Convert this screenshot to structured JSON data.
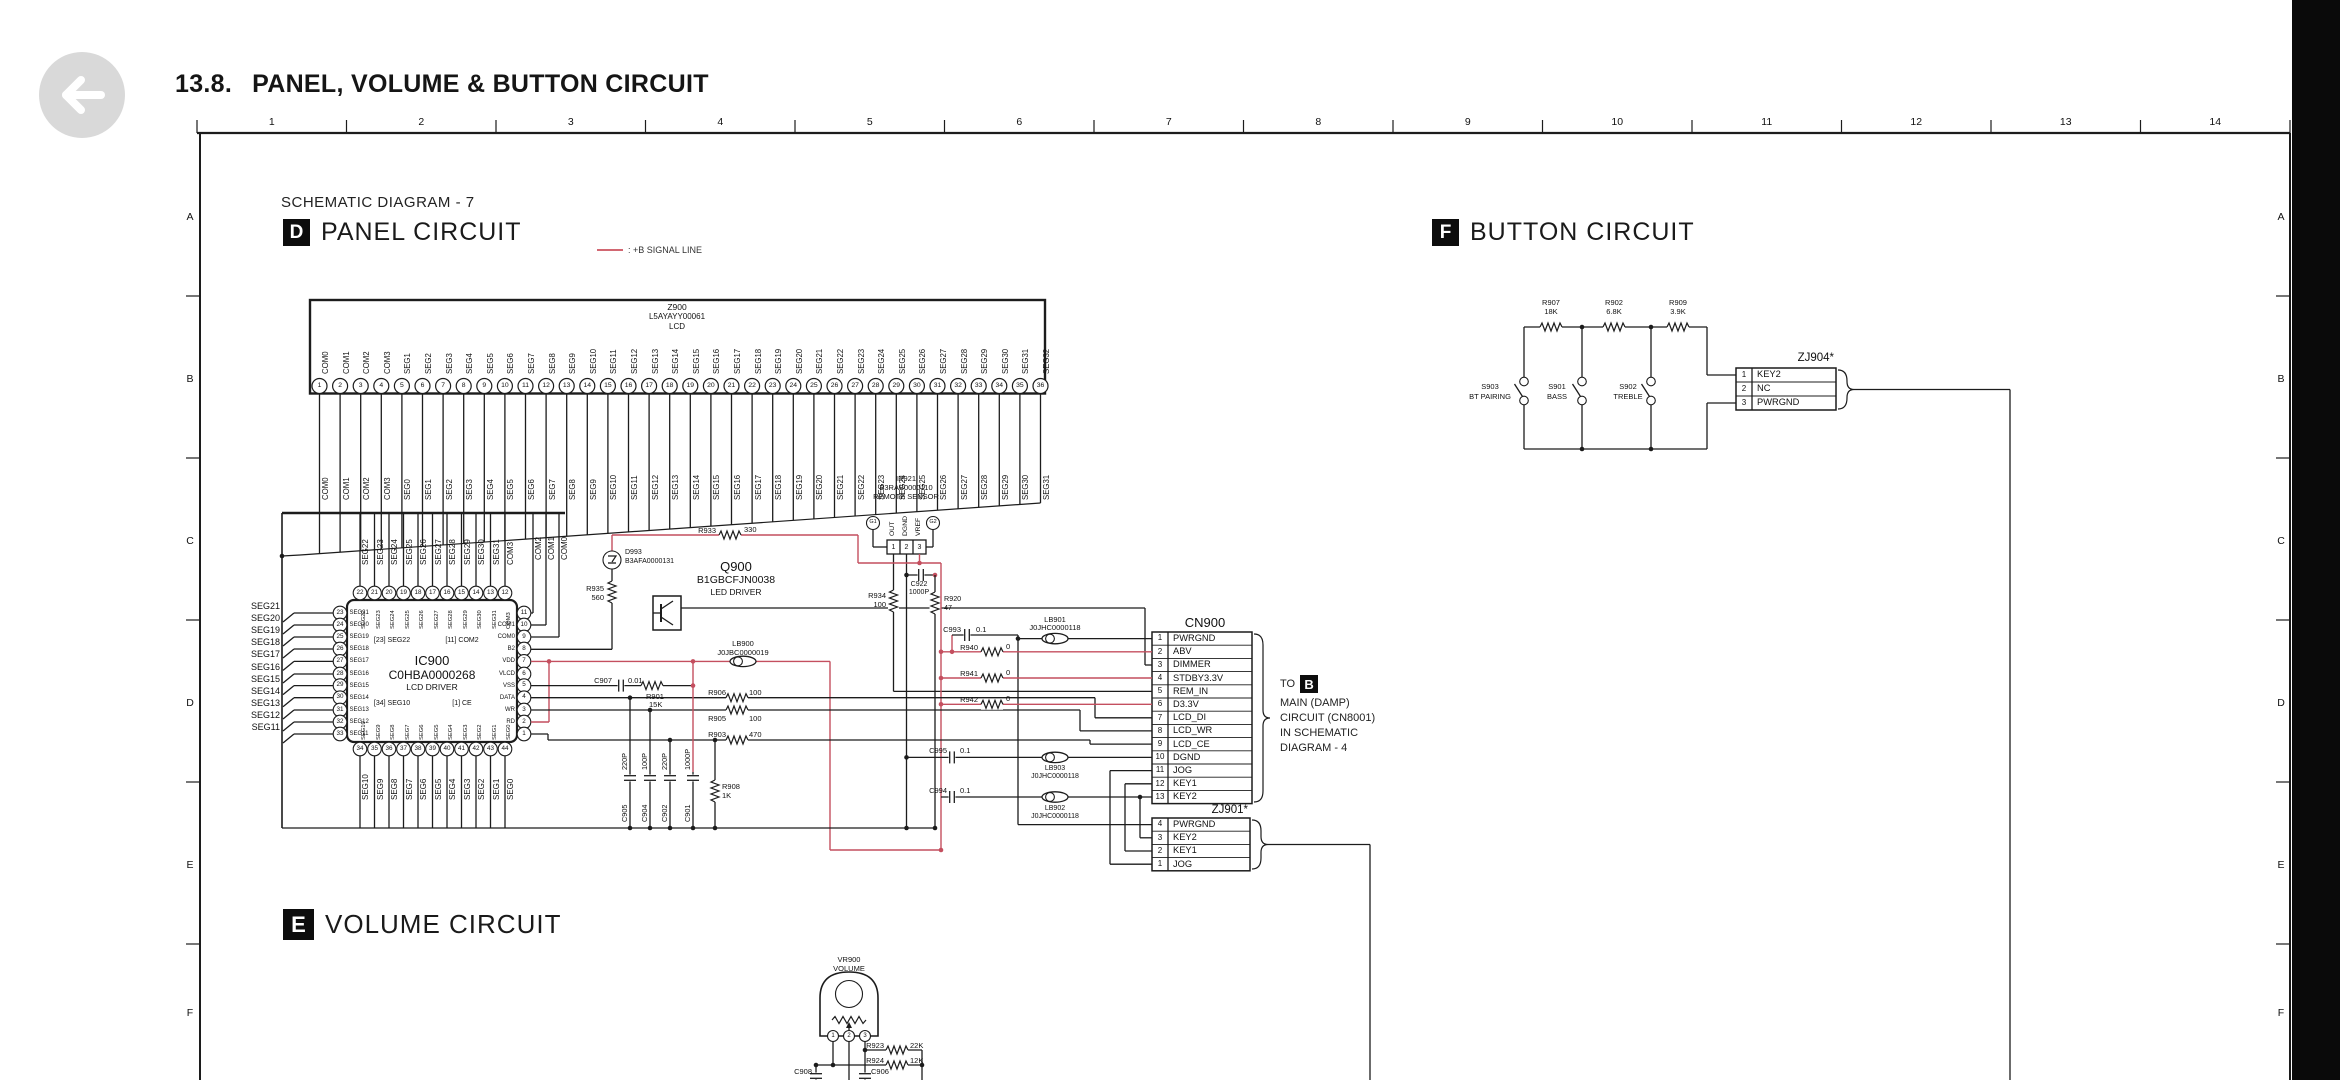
{
  "page": {
    "title_no": "13.8.",
    "title": "PANEL, VOLUME & BUTTON CIRCUIT",
    "schematic_label": "SCHEMATIC DIAGRAM - 7",
    "red": "#c44f5f",
    "black_bar": "#0a0a0a",
    "back_button_icon": "left-arrow"
  },
  "ruler": {
    "columns": [
      "1",
      "2",
      "3",
      "4",
      "5",
      "6",
      "7",
      "8",
      "9",
      "10",
      "11",
      "12",
      "13",
      "14"
    ],
    "rows": [
      "A",
      "B",
      "C",
      "D",
      "E",
      "F"
    ]
  },
  "sections": {
    "panel": {
      "badge": "D",
      "title": "PANEL CIRCUIT"
    },
    "volume": {
      "badge": "E",
      "title": "VOLUME CIRCUIT"
    },
    "button": {
      "badge": "F",
      "title": "BUTTON CIRCUIT"
    }
  },
  "legend": {
    "label": ": +B SIGNAL LINE"
  },
  "z900": {
    "ref": "Z900",
    "part": "L5AYAYY00061",
    "name": "LCD",
    "pin_labels": [
      "COM0",
      "COM1",
      "COM2",
      "COM3",
      "SEG1",
      "SEG2",
      "SEG3",
      "SEG4",
      "SEG5",
      "SEG6",
      "SEG7",
      "SEG8",
      "SEG9",
      "SEG10",
      "SEG11",
      "SEG12",
      "SEG13",
      "SEG14",
      "SEG15",
      "SEG16",
      "SEG17",
      "SEG18",
      "SEG19",
      "SEG20",
      "SEG21",
      "SEG22",
      "SEG23",
      "SEG24",
      "SEG25",
      "SEG26",
      "SEG27",
      "SEG28",
      "SEG29",
      "SEG30",
      "SEG31",
      "SEG32"
    ],
    "net_labels": [
      "COM0",
      "COM1",
      "COM2",
      "COM3",
      "SEG0",
      "SEG1",
      "SEG2",
      "SEG3",
      "SEG4",
      "SEG5",
      "SEG6",
      "SEG7",
      "SEG8",
      "SEG9",
      "SEG10",
      "SEG11",
      "SEG12",
      "SEG13",
      "SEG14",
      "SEG15",
      "SEG16",
      "SEG17",
      "SEG18",
      "SEG19",
      "SEG20",
      "SEG21",
      "SEG22",
      "SEG23",
      "SEG24",
      "SEG25",
      "SEG26",
      "SEG27",
      "SEG28",
      "SEG29",
      "SEG30",
      "SEG31"
    ]
  },
  "ic900": {
    "ref": "IC900",
    "part": "C0HBA0000268",
    "name": "LCD DRIVER",
    "notes": [
      "[23] SEG22",
      "[11] COM2",
      "[34] SEG10",
      "[1] CE"
    ],
    "left": {
      "pins": [
        23,
        24,
        25,
        26,
        27,
        28,
        29,
        30,
        31,
        32,
        33
      ],
      "nets": [
        "SEG21",
        "SEG20",
        "SEG19",
        "SEG18",
        "SEG17",
        "SEG16",
        "SEG15",
        "SEG14",
        "SEG13",
        "SEG12",
        "SEG11"
      ]
    },
    "top": {
      "pins": [
        22,
        21,
        20,
        19,
        18,
        17,
        16,
        15,
        14,
        13,
        12
      ],
      "nets": [
        "SEG22",
        "SEG23",
        "SEG24",
        "SEG25",
        "SEG26",
        "SEG27",
        "SEG28",
        "SEG29",
        "SEG30",
        "SEG31",
        "COM3"
      ]
    },
    "right": {
      "pins": [
        11,
        10,
        9,
        8,
        7,
        6,
        5,
        4,
        3,
        2,
        1
      ],
      "names": [
        "",
        "COM1",
        "COM0",
        "B2",
        "VDD",
        "VLCD",
        "VSS",
        "DATA",
        "WR",
        "RD",
        ""
      ]
    },
    "right_top_nets": [
      "COM2",
      "COM1",
      "COM0"
    ],
    "bottom": {
      "pins": [
        34,
        35,
        36,
        37,
        38,
        39,
        40,
        41,
        42,
        43,
        44
      ],
      "nets": [
        "SEG10",
        "SEG9",
        "SEG8",
        "SEG7",
        "SEG6",
        "SEG5",
        "SEG4",
        "SEG3",
        "SEG2",
        "SEG1",
        "SEG0"
      ]
    }
  },
  "ir921": {
    "ref": "IR921",
    "part": "B3RAB0000110",
    "name": "REMOTE SENSOR",
    "grounds": [
      "G1",
      "G2"
    ],
    "pins": [
      "1",
      "2",
      "3"
    ],
    "pin_names": [
      "OUT",
      "DGND",
      "VREF"
    ]
  },
  "parts": {
    "d993": {
      "ref": "D993",
      "part": "B3AFA0000131"
    },
    "q900": {
      "ref": "Q900",
      "part": "B1GBCFJN0038",
      "name": "LED DRIVER"
    },
    "r933": {
      "ref": "R933",
      "val": "330"
    },
    "r935": {
      "ref": "R935",
      "val": "560"
    },
    "lb900": {
      "ref": "LB900",
      "part": "J0JBC0000019"
    },
    "c907": {
      "ref": "C907",
      "val": "0.01"
    },
    "r901": {
      "ref": "R901",
      "val": "15K"
    },
    "r906": {
      "ref": "R906",
      "val": "100"
    },
    "r905": {
      "ref": "R905",
      "val": "100"
    },
    "r903": {
      "ref": "R903",
      "val": "470"
    },
    "r908": {
      "ref": "R908",
      "val": "1K"
    },
    "caps": [
      {
        "ref": "C905",
        "val": "220P"
      },
      {
        "ref": "C904",
        "val": "100P"
      },
      {
        "ref": "C902",
        "val": "220P"
      },
      {
        "ref": "C901",
        "val": "1000P"
      }
    ],
    "r934": {
      "ref": "R934",
      "val": "100"
    },
    "c922": {
      "ref": "C922",
      "val": "1000P"
    },
    "r920": {
      "ref": "R920",
      "val": "47"
    },
    "c993": {
      "ref": "C993",
      "val": "0.1"
    },
    "r940": {
      "ref": "R940",
      "val": "0"
    },
    "r941": {
      "ref": "R941",
      "val": "0"
    },
    "r942": {
      "ref": "R942",
      "val": "0"
    },
    "c995": {
      "ref": "C995",
      "val": "0.1"
    },
    "c994": {
      "ref": "C994",
      "val": "0.1"
    },
    "lb901": {
      "ref": "LB901",
      "part": "J0JHC0000118"
    },
    "lb903": {
      "ref": "LB903",
      "part": "J0JHC0000118"
    },
    "lb902": {
      "ref": "LB902",
      "part": "J0JHC0000118"
    }
  },
  "cn900": {
    "title": "CN900",
    "pins": [
      {
        "n": "1",
        "label": "PWRGND"
      },
      {
        "n": "2",
        "label": "ABV"
      },
      {
        "n": "3",
        "label": "DIMMER"
      },
      {
        "n": "4",
        "label": "STDBY3.3V"
      },
      {
        "n": "5",
        "label": "REM_IN"
      },
      {
        "n": "6",
        "label": "D3.3V"
      },
      {
        "n": "7",
        "label": "LCD_DI"
      },
      {
        "n": "8",
        "label": "LCD_WR"
      },
      {
        "n": "9",
        "label": "LCD_CE"
      },
      {
        "n": "10",
        "label": "DGND"
      },
      {
        "n": "11",
        "label": "JOG"
      },
      {
        "n": "12",
        "label": "KEY1"
      },
      {
        "n": "13",
        "label": "KEY2"
      }
    ]
  },
  "cn900_note": {
    "prefix": "TO",
    "badge": "B",
    "lines": [
      "MAIN (DAMP)",
      "CIRCUIT (CN8001)",
      "IN SCHEMATIC",
      "DIAGRAM - 4"
    ]
  },
  "zj901": {
    "title": "ZJ901*",
    "pins": [
      {
        "n": "4",
        "label": "PWRGND"
      },
      {
        "n": "3",
        "label": "KEY2"
      },
      {
        "n": "2",
        "label": "KEY1"
      },
      {
        "n": "1",
        "label": "JOG"
      }
    ]
  },
  "zj904": {
    "title": "ZJ904*",
    "pins": [
      {
        "n": "1",
        "label": "KEY2"
      },
      {
        "n": "2",
        "label": "NC"
      },
      {
        "n": "3",
        "label": "PWRGND"
      }
    ]
  },
  "button_circuit": {
    "resistors": [
      {
        "ref": "R907",
        "val": "18K"
      },
      {
        "ref": "R902",
        "val": "6.8K"
      },
      {
        "ref": "R909",
        "val": "3.9K"
      }
    ],
    "switches": [
      {
        "ref": "S903",
        "name": "BT PAIRING"
      },
      {
        "ref": "S901",
        "name": "BASS"
      },
      {
        "ref": "S902",
        "name": "TREBLE"
      }
    ]
  },
  "vr900": {
    "ref": "VR900",
    "name": "VOLUME",
    "pins": [
      "1",
      "2",
      "3"
    ],
    "r923": {
      "ref": "R923",
      "val": "22K"
    },
    "r924": {
      "ref": "R924",
      "val": "12K"
    },
    "c908": "C908",
    "c906": "C906"
  }
}
